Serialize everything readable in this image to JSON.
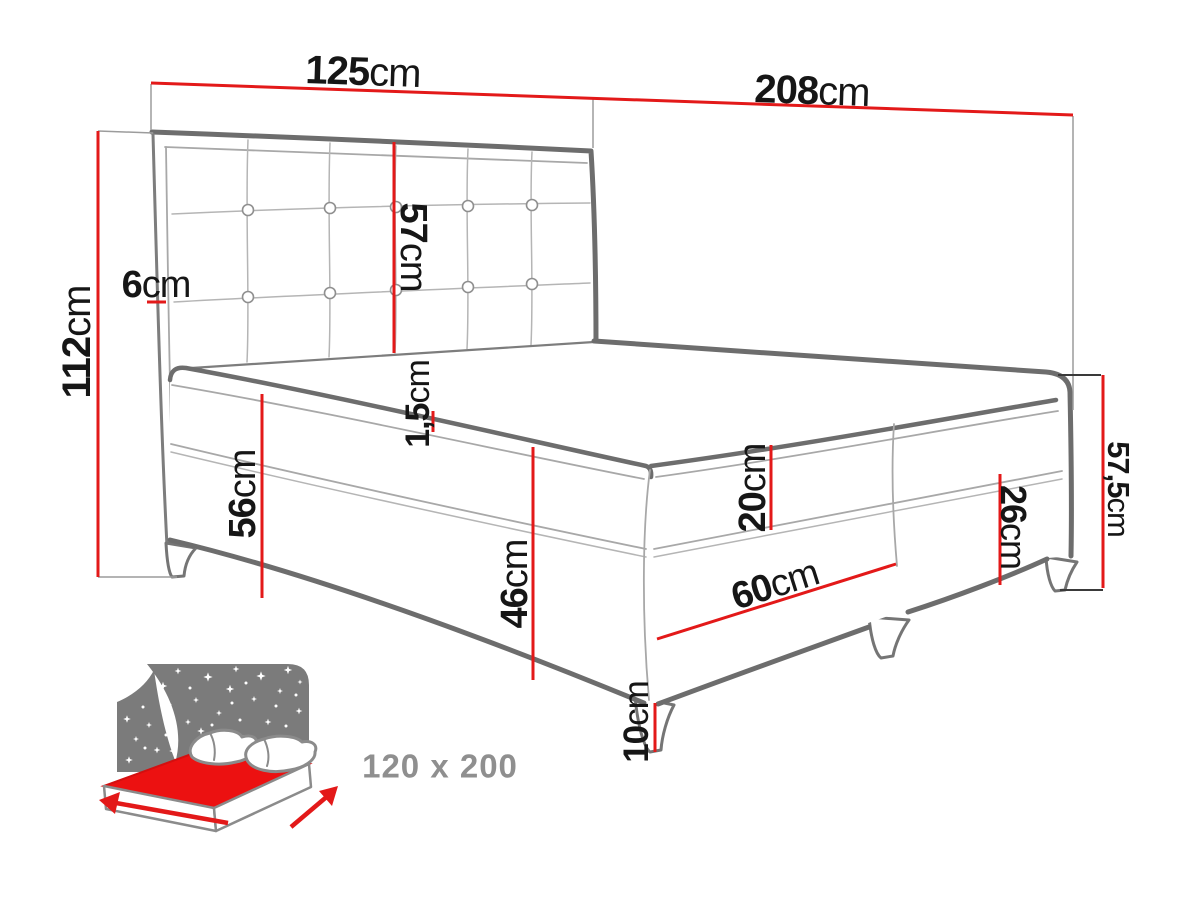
{
  "diagram": {
    "dimensions": {
      "d125": {
        "num": "125",
        "unit": "cm"
      },
      "d208": {
        "num": "208",
        "unit": "cm"
      },
      "d112": {
        "num": "112",
        "unit": "cm"
      },
      "d6": {
        "num": "6",
        "unit": "cm"
      },
      "d57": {
        "num": "57",
        "unit": "cm"
      },
      "d15": {
        "num": "1,5",
        "unit": "cm"
      },
      "d56": {
        "num": "56",
        "unit": "cm"
      },
      "d46": {
        "num": "46",
        "unit": "cm"
      },
      "d20": {
        "num": "20",
        "unit": "cm"
      },
      "d60": {
        "num": "60",
        "unit": "cm"
      },
      "d26": {
        "num": "26",
        "unit": "cm"
      },
      "d575": {
        "num": "57,5",
        "unit": "cm"
      },
      "d10": {
        "num": "10",
        "unit": "cm"
      }
    },
    "badge": {
      "size_label": "120 x 200"
    },
    "colors": {
      "dimension_red": "#e31919",
      "outline_gray": "#6d6d6d",
      "seam_gray": "#a8a8a8",
      "label_black": "#161616",
      "badge_panel_gray": "#7b7b7b",
      "badge_text_gray": "#8f8f8f",
      "badge_mattress_red": "#ec1111"
    }
  }
}
